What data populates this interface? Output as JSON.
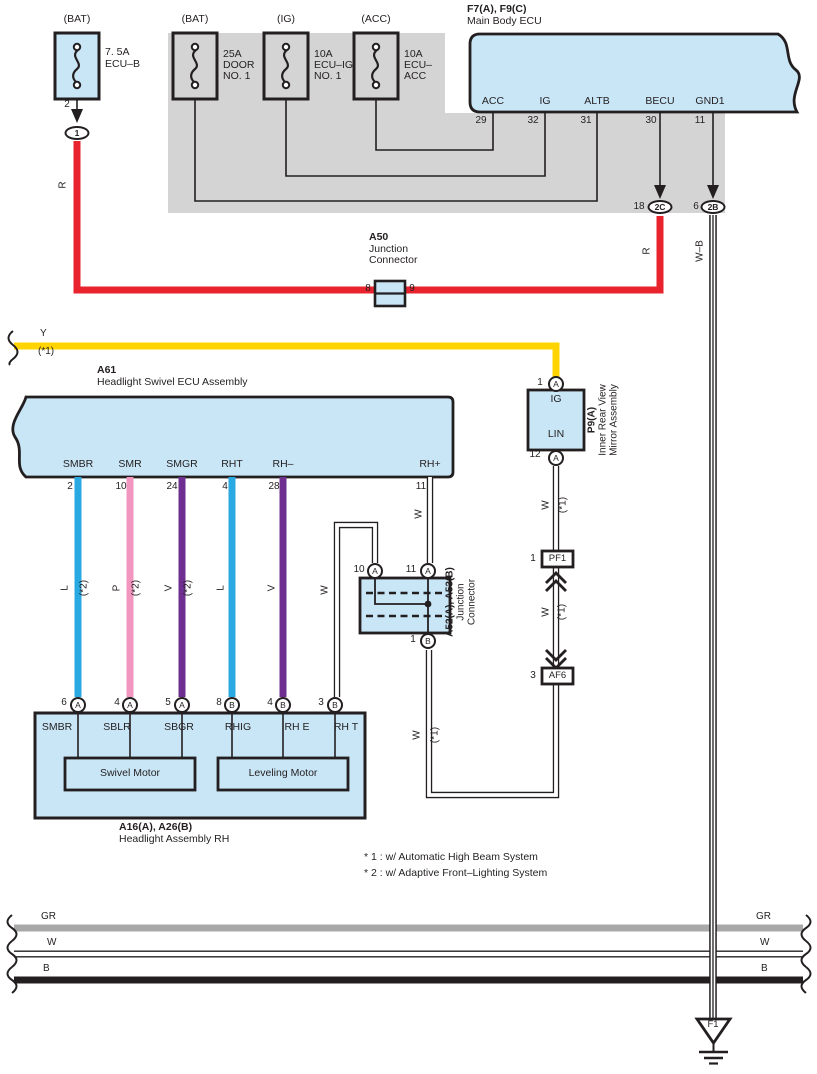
{
  "colors": {
    "panel_gray": "#d4d4d4",
    "box_blue": "#c9e6f7",
    "wire_red": "#e8232d",
    "wire_yellow": "#ffd400",
    "wire_blue": "#29a9e1",
    "wire_pink": "#f295bf",
    "wire_violet": "#6e2f91",
    "bus_gray": "#a8a8a8",
    "line": "#231f20"
  },
  "fuses": [
    {
      "top": "(BAT)",
      "l1": "7. 5A",
      "l2": "ECU–B",
      "l3": ""
    },
    {
      "top": "(BAT)",
      "l1": "25A",
      "l2": "DOOR",
      "l3": "NO. 1"
    },
    {
      "top": "(IG)",
      "l1": "10A",
      "l2": "ECU–IG",
      "l3": "NO. 1"
    },
    {
      "top": "(ACC)",
      "l1": "10A",
      "l2": "ECU–",
      "l3": "ACC"
    }
  ],
  "fuse1_pin": "2",
  "fuse1_oval": "1",
  "ecu": {
    "id": "F7(A), F9(C)",
    "name": "Main Body ECU",
    "pins": [
      {
        "name": "ACC",
        "num": "29"
      },
      {
        "name": "IG",
        "num": "32"
      },
      {
        "name": "ALTB",
        "num": "31"
      },
      {
        "name": "BECU",
        "num": "30"
      },
      {
        "name": "GND1",
        "num": "11"
      }
    ]
  },
  "conn_2c": {
    "num": "18",
    "label": "2C"
  },
  "conn_2b": {
    "num": "6",
    "label": "2B"
  },
  "a50": {
    "id": "A50",
    "l1": "Junction",
    "l2": "Connector",
    "pin_l": "8",
    "pin_r": "9"
  },
  "wire_labels": {
    "r1": "R",
    "r2": "R",
    "wb": "W–B",
    "y": "Y",
    "y_ref": "(*1)",
    "w_loop": "W",
    "w_p9": "W",
    "w_p9_ref": "(*1)",
    "w_mid": "W",
    "w_mid_ref": "(*1)",
    "w_low": "W",
    "w_low_ref": "(*1)"
  },
  "a61": {
    "id": "A61",
    "name": "Headlight Swivel ECU Assembly",
    "pins": [
      {
        "name": "SMBR",
        "num": "2",
        "code": "L",
        "ref": "(*2)"
      },
      {
        "name": "SMR",
        "num": "10",
        "code": "P",
        "ref": "(*2)"
      },
      {
        "name": "SMGR",
        "num": "24",
        "code": "V",
        "ref": "(*2)"
      },
      {
        "name": "RHT",
        "num": "4",
        "code": "L",
        "ref": ""
      },
      {
        "name": "RH–",
        "num": "28",
        "code": "V",
        "ref": ""
      },
      {
        "name": "RH+",
        "num": "11",
        "code": "W",
        "ref": ""
      }
    ]
  },
  "p9": {
    "num_top": "1",
    "ring_top": "A",
    "pin_top": "IG",
    "pin_bottom": "LIN",
    "num_bottom": "12",
    "ring_bottom": "A",
    "id": "P9(A)",
    "name1": "Inner Rear View",
    "name2": "Mirror Assembly"
  },
  "pf1": {
    "num": "1",
    "label": "PF1"
  },
  "af6": {
    "num": "3",
    "label": "AF6"
  },
  "junction": {
    "id": "A52(A), A53(B)",
    "l1": "Junction",
    "l2": "Connector",
    "pins": [
      {
        "num": "10",
        "ring": "A"
      },
      {
        "num": "11",
        "ring": "A"
      },
      {
        "num": "1",
        "ring": "B"
      }
    ]
  },
  "headlight": {
    "id": "A16(A), A26(B)",
    "name": "Headlight Assembly RH",
    "motor1": "Swivel Motor",
    "motor2": "Leveling Motor",
    "pins": [
      {
        "num": "6",
        "ring": "A",
        "name": "SMBR"
      },
      {
        "num": "4",
        "ring": "A",
        "name": "SBLR"
      },
      {
        "num": "5",
        "ring": "A",
        "name": "SBGR"
      },
      {
        "num": "8",
        "ring": "B",
        "name": "RHIG"
      },
      {
        "num": "4",
        "ring": "B",
        "name": "RH E"
      },
      {
        "num": "3",
        "ring": "B",
        "name": "RH T"
      }
    ]
  },
  "notes": {
    "n1": "* 1 : w/ Automatic High Beam System",
    "n2": "* 2 : w/ Adaptive Front–Lighting System"
  },
  "buses": [
    {
      "label": "GR"
    },
    {
      "label": "W"
    },
    {
      "label": "B"
    }
  ],
  "ground": {
    "label": "F1"
  }
}
